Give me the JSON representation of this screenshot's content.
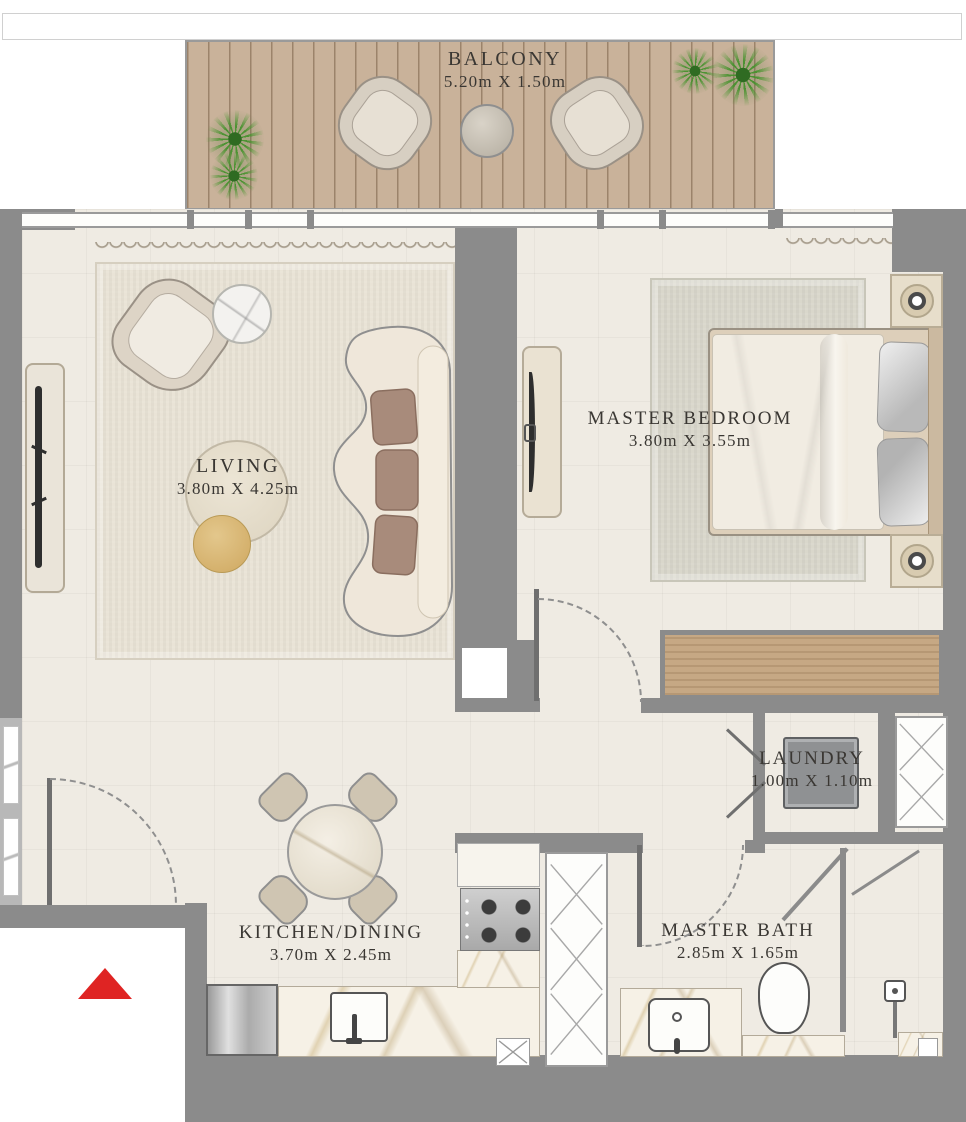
{
  "title": "Apartment Floor Plan",
  "rooms": {
    "balcony": {
      "name": "BALCONY",
      "dims": "5.20m X 1.50m"
    },
    "living": {
      "name": "LIVING",
      "dims": "3.80m X 4.25m"
    },
    "master_bedroom": {
      "name": "MASTER BEDROOM",
      "dims": "3.80m X 3.55m"
    },
    "laundry": {
      "name": "LAUNDRY",
      "dims": "1.00m X 1.10m"
    },
    "kitchen_dining": {
      "name": "KITCHEN/DINING",
      "dims": "3.70m X 2.45m"
    },
    "master_bath": {
      "name": "MASTER BATH",
      "dims": "2.85m X 1.65m"
    }
  },
  "colors": {
    "wall": "#8b8b8b",
    "floor": "#efebe3",
    "deck": "#c9b29a",
    "accent-red": "#df2423",
    "text": "#3a3733",
    "wood": "#c6a884",
    "marble": "#f6f1e6",
    "rug-living": "#e9e3d6",
    "rug-bedroom": "#d9d7cb",
    "line": "#9a9a9a"
  },
  "icons": {
    "entry-arrow": "red triangle pointing up (unit entrance)",
    "plant": "green starburst (potted plant, top view)",
    "shaft-cross": "X-hatched rectangle (duct/shaft)",
    "lamp": "ring circle (table lamp, top view)",
    "door-swing": "dashed quarter arc"
  }
}
